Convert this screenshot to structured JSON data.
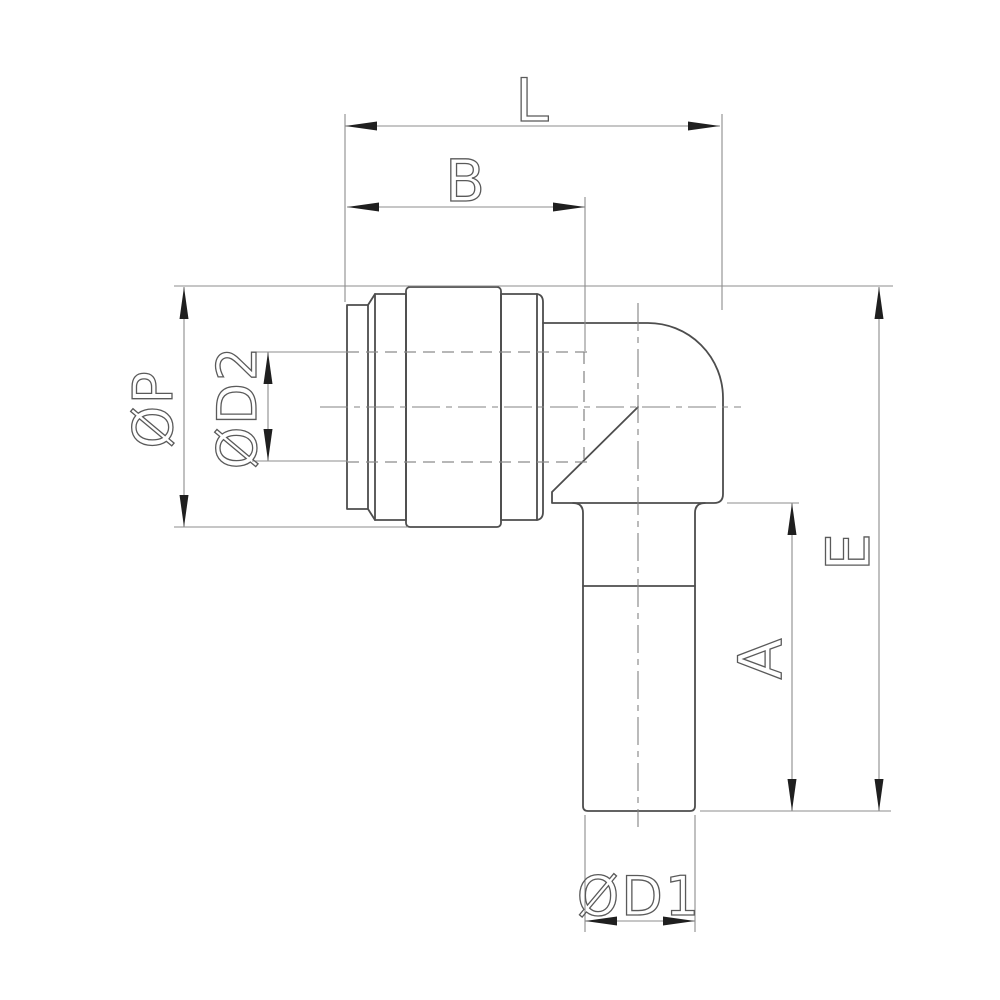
{
  "drawing": {
    "labels": {
      "L": "L",
      "B": "B",
      "P": "ØP",
      "D2": "ØD2",
      "E": "E",
      "A": "A",
      "D1": "ØD1"
    },
    "colors": {
      "background": "#ffffff",
      "part_line": "#4d4d4d",
      "dimension_line": "#8c8c8c",
      "arrowhead": "#1f1f1f",
      "label_stroke": "#5a5a5a"
    }
  }
}
